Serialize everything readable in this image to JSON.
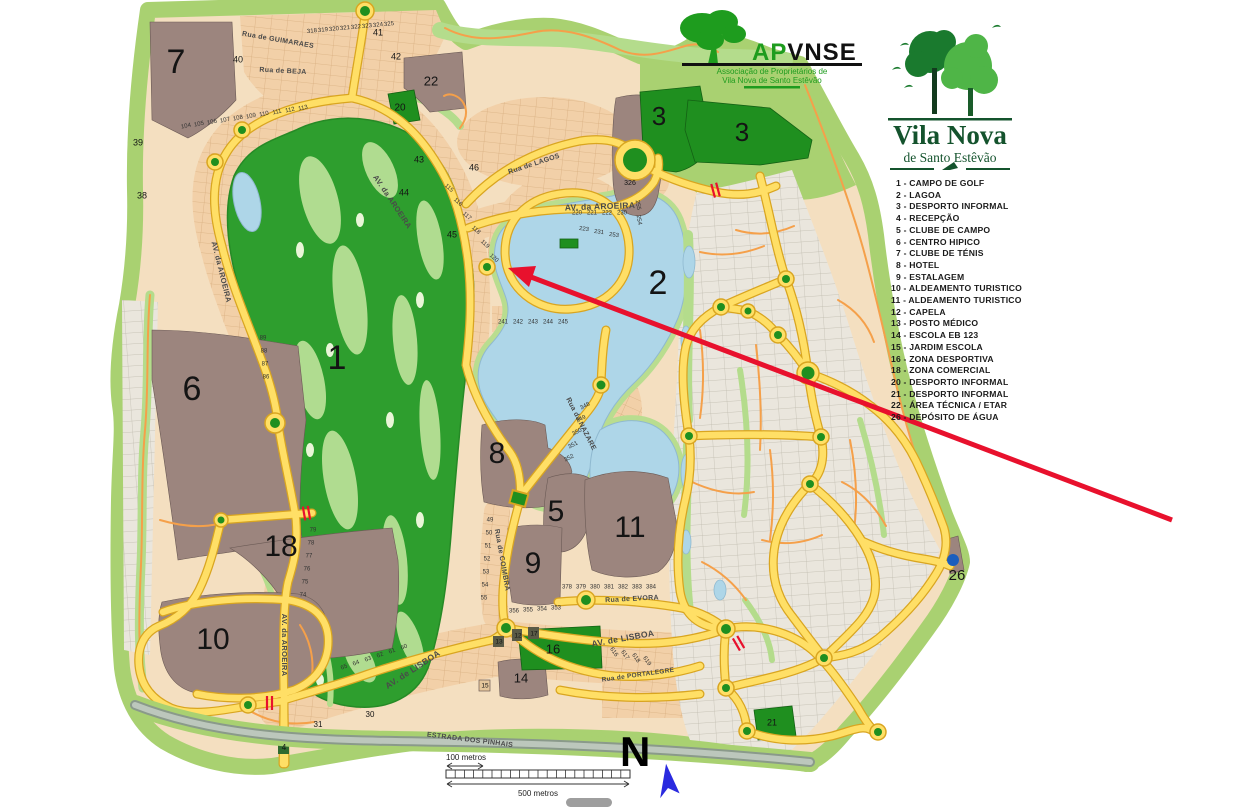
{
  "colors": {
    "land_cream": "#F4DFC0",
    "border_green": "#A9D171",
    "plot_tan": "#F2D0A8",
    "plot_gray": "#EAE6DD",
    "zone_brown": "#9C857E",
    "zone_green": "#1F8F1F",
    "golf_green": "#2E9E2E",
    "lake_blue": "#AED6E8",
    "road_yellow": "#FFDF66",
    "road_casing": "#D9A520",
    "road_minor_orange": "#F5A04A",
    "arrow_red": "#E8112D",
    "north_blue": "#2A2ADF",
    "logo_green": "#1E9C1E",
    "logo_dark_green": "#14532D"
  },
  "apvnse_logo": {
    "acronym_left": "AP",
    "acronym_right": "VNSE",
    "subtitle_line1": "Associação de Proprietários de",
    "subtitle_line2": "Vila Nova de Santo Estêvão"
  },
  "vnse_logo": {
    "title": "Vila Nova",
    "subtitle": "de Santo Estêvão"
  },
  "legend": {
    "items": [
      "1 - CAMPO DE GOLF",
      "2 - LAGOA",
      "3 - DESPORTO INFORMAL",
      "4 - RECEPÇÃO",
      "5 - CLUBE DE CAMPO",
      "6 - CENTRO HIPICO",
      "7 - CLUBE DE TÉNIS",
      "8 - HOTEL",
      "9 - ESTALAGEM",
      "10 - ALDEAMENTO TURISTICO",
      "11 - ALDEAMENTO TURISTICO",
      "12 - CAPELA",
      "13 - POSTO MÉDICO",
      "14 - ESCOLA EB 123",
      "15 - JARDIM ESCOLA",
      "16 - ZONA DESPORTIVA",
      "18 - ZONA COMERCIAL",
      "20 - DESPORTO INFORMAL",
      "21 - DESPORTO INFORMAL",
      "22 - ÁREA TÉCNICA / ETAR",
      "26 - DEPÓSITO DE ÁGUA"
    ]
  },
  "north_label": "N",
  "scale": {
    "small": "100 metros",
    "large": "500 metros"
  },
  "map": {
    "zone_labels": [
      {
        "n": "1",
        "x": 337,
        "y": 360,
        "s": 34
      },
      {
        "n": "2",
        "x": 658,
        "y": 285,
        "s": 34
      },
      {
        "n": "3",
        "x": 659,
        "y": 118,
        "s": 26
      },
      {
        "n": "3",
        "x": 742,
        "y": 134,
        "s": 26
      },
      {
        "n": "5",
        "x": 556,
        "y": 513,
        "s": 30
      },
      {
        "n": "6",
        "x": 192,
        "y": 391,
        "s": 34
      },
      {
        "n": "7",
        "x": 176,
        "y": 64,
        "s": 34
      },
      {
        "n": "8",
        "x": 497,
        "y": 455,
        "s": 30
      },
      {
        "n": "9",
        "x": 533,
        "y": 565,
        "s": 30
      },
      {
        "n": "10",
        "x": 213,
        "y": 641,
        "s": 30
      },
      {
        "n": "11",
        "x": 630,
        "y": 529,
        "s": 30
      },
      {
        "n": "14",
        "x": 521,
        "y": 679,
        "s": 13
      },
      {
        "n": "16",
        "x": 553,
        "y": 650,
        "s": 13
      },
      {
        "n": "18",
        "x": 281,
        "y": 548,
        "s": 30
      },
      {
        "n": "20",
        "x": 400,
        "y": 108,
        "s": 10
      },
      {
        "n": "21",
        "x": 772,
        "y": 723,
        "s": 9
      },
      {
        "n": "22",
        "x": 431,
        "y": 82,
        "s": 13
      },
      {
        "n": "26",
        "x": 957,
        "y": 576,
        "s": 15
      },
      {
        "n": "326",
        "x": 630,
        "y": 183,
        "s": 7
      },
      {
        "n": "30",
        "x": 370,
        "y": 715,
        "s": 8
      },
      {
        "n": "31",
        "x": 318,
        "y": 725,
        "s": 8
      },
      {
        "n": "38",
        "x": 142,
        "y": 196,
        "s": 9
      },
      {
        "n": "39",
        "x": 138,
        "y": 143,
        "s": 9
      },
      {
        "n": "40",
        "x": 238,
        "y": 60,
        "s": 9
      },
      {
        "n": "41",
        "x": 378,
        "y": 33,
        "s": 9
      },
      {
        "n": "42",
        "x": 396,
        "y": 57,
        "s": 9
      },
      {
        "n": "43",
        "x": 419,
        "y": 160,
        "s": 9
      },
      {
        "n": "44",
        "x": 404,
        "y": 193,
        "s": 9
      },
      {
        "n": "45",
        "x": 452,
        "y": 235,
        "s": 9
      },
      {
        "n": "46",
        "x": 474,
        "y": 168,
        "s": 9
      },
      {
        "n": "4",
        "x": 284,
        "y": 748,
        "s": 8,
        "c": "#ffffff"
      },
      {
        "n": "12",
        "x": 518,
        "y": 636,
        "s": 6.5
      },
      {
        "n": "13",
        "x": 499,
        "y": 642,
        "s": 6.5
      },
      {
        "n": "17",
        "x": 534,
        "y": 634,
        "s": 6.5
      },
      {
        "n": "15",
        "x": 485,
        "y": 686,
        "s": 6.5
      }
    ],
    "street_labels": [
      {
        "t": "AV. da AROEIRA",
        "x": 600,
        "y": 207,
        "r": -2,
        "s": 8.5
      },
      {
        "t": "AV. da AROEIRA",
        "x": 392,
        "y": 202,
        "r": 56,
        "s": 7.5
      },
      {
        "t": "AV. da AROEIRA",
        "x": 221,
        "y": 272,
        "r": 76,
        "s": 7.5
      },
      {
        "t": "AV. da AROEIRA",
        "x": 284,
        "y": 645,
        "r": 90,
        "s": 7.5
      },
      {
        "t": "AV. de LISBOA",
        "x": 413,
        "y": 670,
        "r": -33,
        "s": 8.5
      },
      {
        "t": "AV. de LISBOA",
        "x": 623,
        "y": 639,
        "r": -10,
        "s": 8.5
      },
      {
        "t": "Rua de EVORA",
        "x": 632,
        "y": 599,
        "r": -3,
        "s": 7
      },
      {
        "t": "Rua de COIMBRA",
        "x": 502,
        "y": 560,
        "r": 80,
        "s": 7
      },
      {
        "t": "Rua de GUIMARAES",
        "x": 278,
        "y": 40,
        "r": 10,
        "s": 7
      },
      {
        "t": "Rua de BEJA",
        "x": 283,
        "y": 71,
        "r": 3,
        "s": 7
      },
      {
        "t": "Rua de LAGOS",
        "x": 534,
        "y": 164,
        "r": -18,
        "s": 7
      },
      {
        "t": "Rua da NAZARE",
        "x": 581,
        "y": 424,
        "r": 63,
        "s": 7
      },
      {
        "t": "Rua de PORTALEGRE",
        "x": 638,
        "y": 675,
        "r": -8,
        "s": 6.5
      },
      {
        "t": "ESTRADA DOS PINHAIS",
        "x": 470,
        "y": 740,
        "r": 7,
        "s": 7,
        "c": "#2f3e2f"
      }
    ],
    "plot_clusters": [
      {
        "x": 312,
        "y": 31,
        "dx": 11,
        "dy": -1,
        "r": -6,
        "nums": [
          "318",
          "319",
          "320",
          "321",
          "322",
          "323",
          "324",
          "325"
        ]
      },
      {
        "x": 186,
        "y": 126,
        "dx": 13,
        "dy": -2,
        "r": -12,
        "nums": [
          "104",
          "105",
          "106",
          "107",
          "108",
          "109",
          "110",
          "111",
          "112",
          "113"
        ]
      },
      {
        "x": 449,
        "y": 188,
        "dx": 9,
        "dy": 14,
        "r": 42,
        "nums": [
          "115",
          "116",
          "117",
          "118",
          "119",
          "120"
        ]
      },
      {
        "x": 577,
        "y": 213,
        "dx": 15,
        "dy": 0,
        "r": 0,
        "nums": [
          "220",
          "221",
          "222",
          "230"
        ]
      },
      {
        "x": 584,
        "y": 229,
        "dx": 15,
        "dy": 3,
        "r": 8,
        "nums": [
          "223",
          "231",
          "253"
        ]
      },
      {
        "x": 638,
        "y": 205,
        "dx": 1,
        "dy": 15,
        "r": 80,
        "nums": [
          "255",
          "254"
        ]
      },
      {
        "x": 503,
        "y": 322,
        "dx": 15,
        "dy": 0,
        "r": 0,
        "nums": [
          "241",
          "242",
          "243",
          "244",
          "245"
        ]
      },
      {
        "x": 490,
        "y": 520,
        "dx": -1,
        "dy": 13,
        "r": 0,
        "nums": [
          "49",
          "50",
          "51",
          "52",
          "53",
          "54",
          "55"
        ]
      },
      {
        "x": 567,
        "y": 587,
        "dx": 14,
        "dy": 0,
        "r": 0,
        "nums": [
          "378",
          "379",
          "380",
          "381",
          "382",
          "383",
          "384"
        ]
      },
      {
        "x": 514,
        "y": 611,
        "dx": 14,
        "dy": -1,
        "r": 0,
        "nums": [
          "356",
          "355",
          "354",
          "353"
        ]
      },
      {
        "x": 263,
        "y": 338,
        "dx": 1,
        "dy": 13,
        "r": 0,
        "nums": [
          "89",
          "88",
          "87",
          "86"
        ]
      },
      {
        "x": 585,
        "y": 406,
        "dx": -4,
        "dy": 13,
        "r": -28,
        "nums": [
          "348",
          "349",
          "350",
          "351",
          "352"
        ]
      },
      {
        "x": 344,
        "y": 667,
        "dx": 12,
        "dy": -4,
        "r": -22,
        "nums": [
          "65",
          "64",
          "63",
          "62",
          "61",
          "60"
        ]
      },
      {
        "x": 313,
        "y": 530,
        "dx": -2,
        "dy": 13,
        "r": 0,
        "nums": [
          "79",
          "78",
          "77",
          "76",
          "75",
          "74"
        ]
      },
      {
        "x": 614,
        "y": 652,
        "dx": 11,
        "dy": 3,
        "r": 55,
        "nums": [
          "616",
          "617",
          "618",
          "619"
        ]
      }
    ]
  }
}
